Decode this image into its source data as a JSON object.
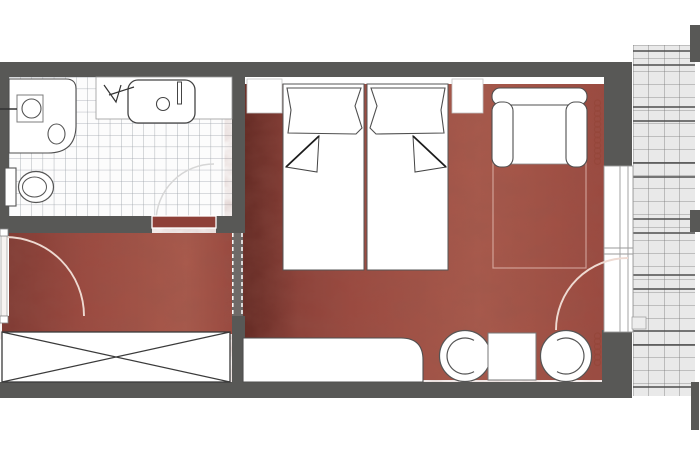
{
  "type": "floor-plan",
  "title": "hotel-room-floor-plan",
  "colors": {
    "wall": "#585856",
    "carpet": "#9b4a40",
    "carpet_dark": "#7e3a33",
    "carpet_light": "#a85a4c",
    "bath_tile_bg": "#fcfcfc",
    "bath_tile_line": "#9ba1a8",
    "balcony_bg": "#e9e9e9",
    "balcony_line": "#767676",
    "balcony_line_strong": "#4e4e4e",
    "outline": "#4f4f4f",
    "radiator": "#95473b",
    "door_arc": "#eedad2",
    "threshold": "#8e4038"
  },
  "icons": {
    "bathtub": "bathtub-icon",
    "sink": "sink-icon",
    "toilet": "toilet-icon",
    "shower_fixture": "shower-fixture-icon",
    "twin_beds": "bed-icon",
    "sofa": "sofa-icon",
    "wardrobe": "wardrobe-cross-icon",
    "desk": "desk-icon",
    "tub_chairs": "chair-icon",
    "table": "table-icon",
    "radiator": "radiator-coil-icon",
    "door_swing": "door-swing-arc-icon",
    "balcony": "balcony-tiles-icon"
  }
}
